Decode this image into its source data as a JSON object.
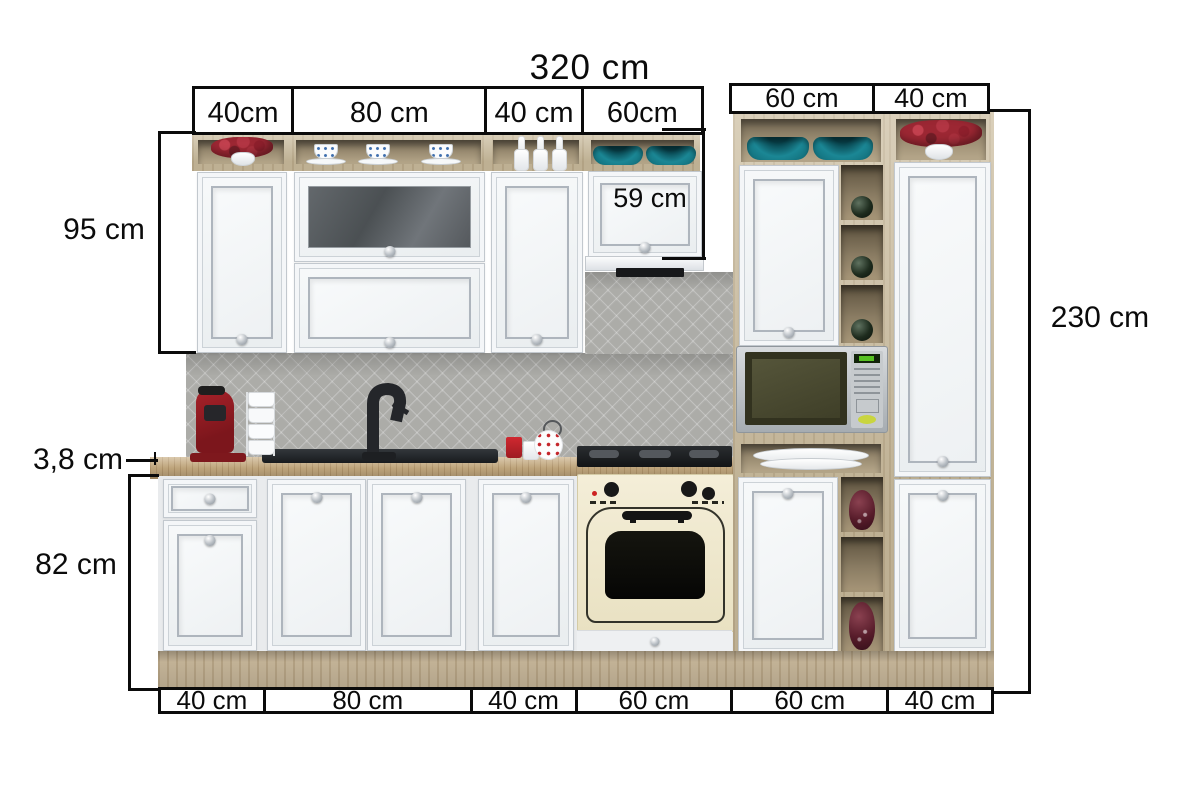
{
  "diagram": {
    "title": "320 cm",
    "top_segments": [
      "40cm",
      "80 cm",
      "40 cm",
      "60cm"
    ],
    "top_right_segments": [
      "60 cm",
      "40 cm"
    ],
    "bottom_segments": [
      "40 cm",
      "80 cm",
      "40 cm",
      "60 cm",
      "60 cm",
      "40 cm"
    ],
    "left": {
      "wall_cabinet_height": "95 cm",
      "countertop_thickness": "3,8 cm",
      "base_cabinet_height": "82 cm"
    },
    "right": {
      "total_height": "230 cm"
    },
    "hood_cabinet_height": "59 cm"
  },
  "colors": {
    "annotation": "#0b0b0b",
    "cabinet_white": "#f2f4f6",
    "wood_carcass": "#cabb9c",
    "countertop_wood": "#c8ad82",
    "backsplash_gray": "#acaca8",
    "teal_accent": "#147d8b",
    "oven_cream": "#f0e9d0",
    "appliance_red": "#8e1b20",
    "vase_burgundy": "#571c2a"
  }
}
